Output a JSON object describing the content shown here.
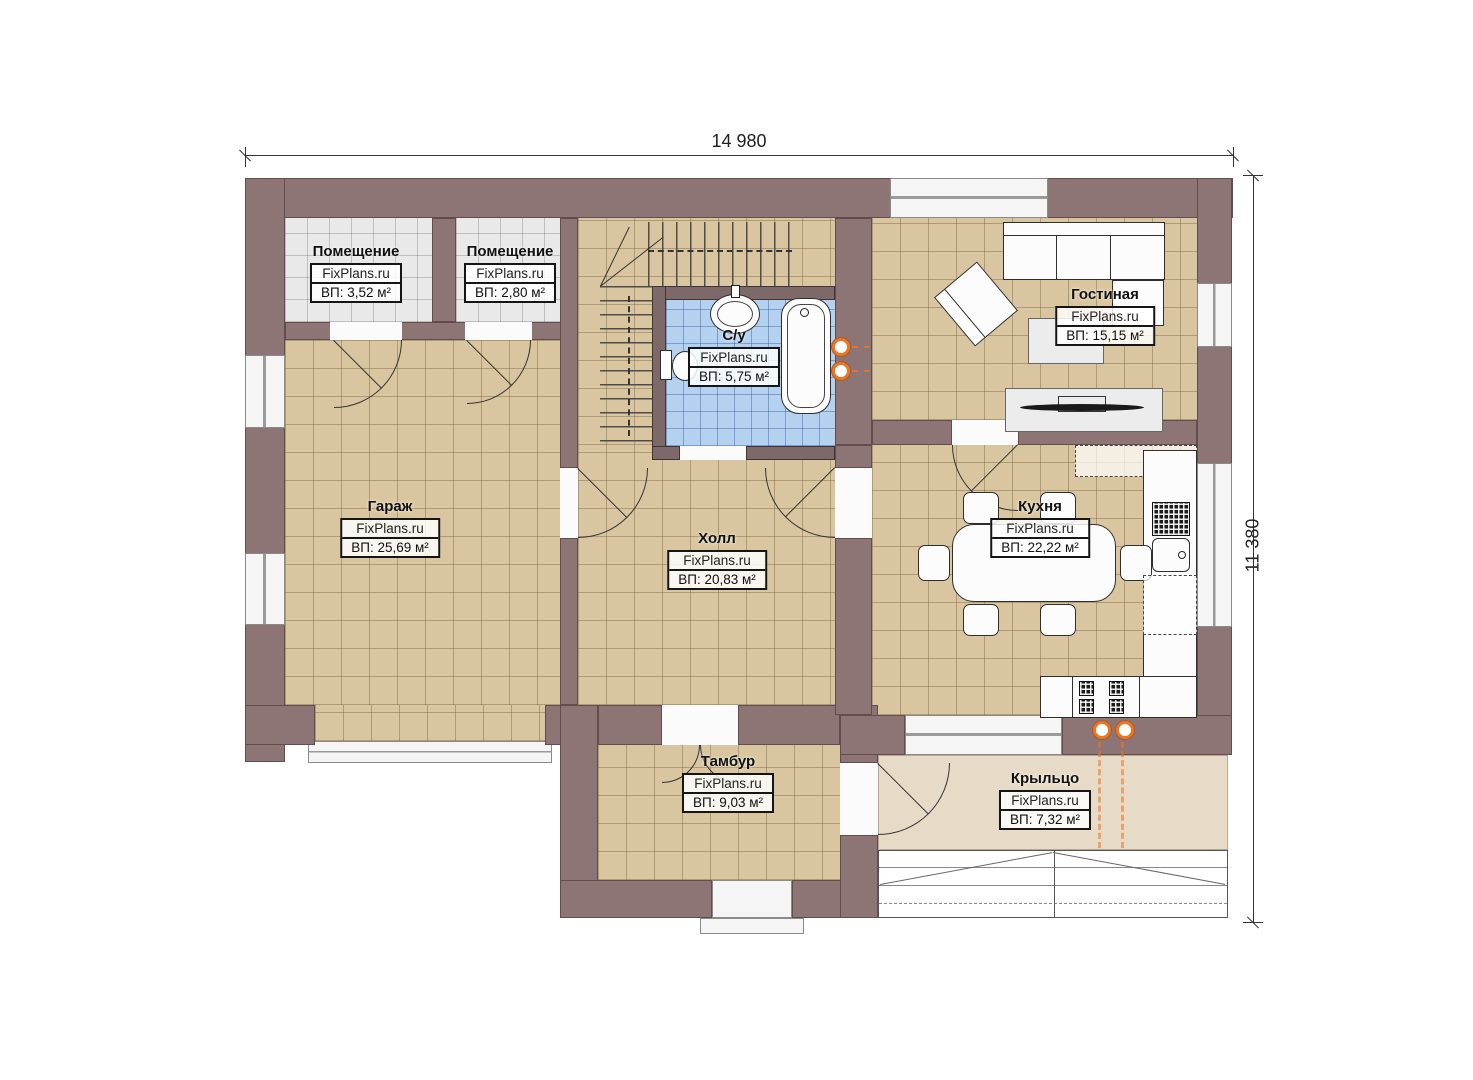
{
  "watermark": "FixPlans.ru",
  "dimensions": {
    "width": "14 980",
    "height": "11 380"
  },
  "rooms": {
    "storage1": {
      "name": "Помещение",
      "area": "ВП: 3,52 м²"
    },
    "storage2": {
      "name": "Помещение",
      "area": "ВП: 2,80 м²"
    },
    "bathroom": {
      "name": "С/у",
      "area": "ВП: 5,75 м²"
    },
    "living": {
      "name": "Гостиная",
      "area": "ВП: 15,15 м²"
    },
    "garage": {
      "name": "Гараж",
      "area": "ВП: 25,69 м²"
    },
    "hall": {
      "name": "Холл",
      "area": "ВП: 20,83 м²"
    },
    "kitchen": {
      "name": "Кухня",
      "area": "ВП: 22,22 м²"
    },
    "vestibule": {
      "name": "Тамбур",
      "area": "ВП: 9,03 м²"
    },
    "porch": {
      "name": "Крыльцо",
      "area": "ВП: 7,32 м²"
    }
  },
  "colors": {
    "wall": "#8d7475",
    "floor_tan": "#d9c6a0",
    "floor_gray": "#e9e9e9",
    "floor_blue": "#b4d1f0",
    "porch": "#e7dac6",
    "accent_orange": "#e87728"
  }
}
